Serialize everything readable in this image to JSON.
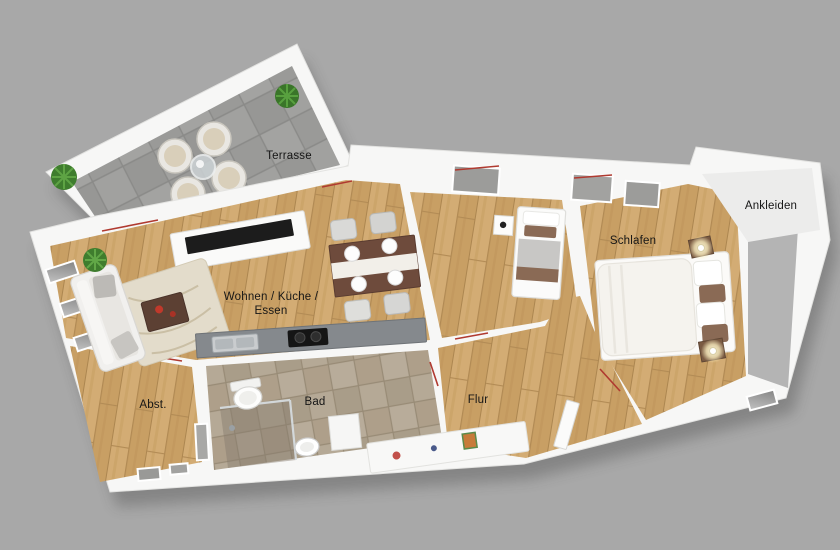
{
  "floorplan": {
    "type": "3d-apartment-floorplan",
    "rooms": [
      {
        "id": "terrasse",
        "label": "Terrasse"
      },
      {
        "id": "wohnen",
        "label": "Wohnen / Küche /",
        "label2": "Essen"
      },
      {
        "id": "schlafen",
        "label": "Schlafen"
      },
      {
        "id": "ankleiden",
        "label": "Ankleiden"
      },
      {
        "id": "abstellraum",
        "label": "Abst."
      },
      {
        "id": "bad",
        "label": "Bad"
      },
      {
        "id": "flur",
        "label": "Flur"
      }
    ],
    "colors": {
      "background": "#a8a8a8",
      "wall_white": "#f7f7f6",
      "wall_face": "#b4b4b4",
      "wood_floor": "#cfa76d",
      "terrace_tile": "#9d9d9b",
      "bath_tile": "#b3a795",
      "dressing_floor": "#ececeb",
      "door_marker": "#b03a30",
      "kitchen_counter": "#85898d",
      "table_brown": "#6e4b3c",
      "pillow_brown": "#8a6a55",
      "plant_green": "#3f7d2e",
      "lamp_glow": "#fff3c4",
      "tv_black": "#1c1c1c"
    }
  }
}
